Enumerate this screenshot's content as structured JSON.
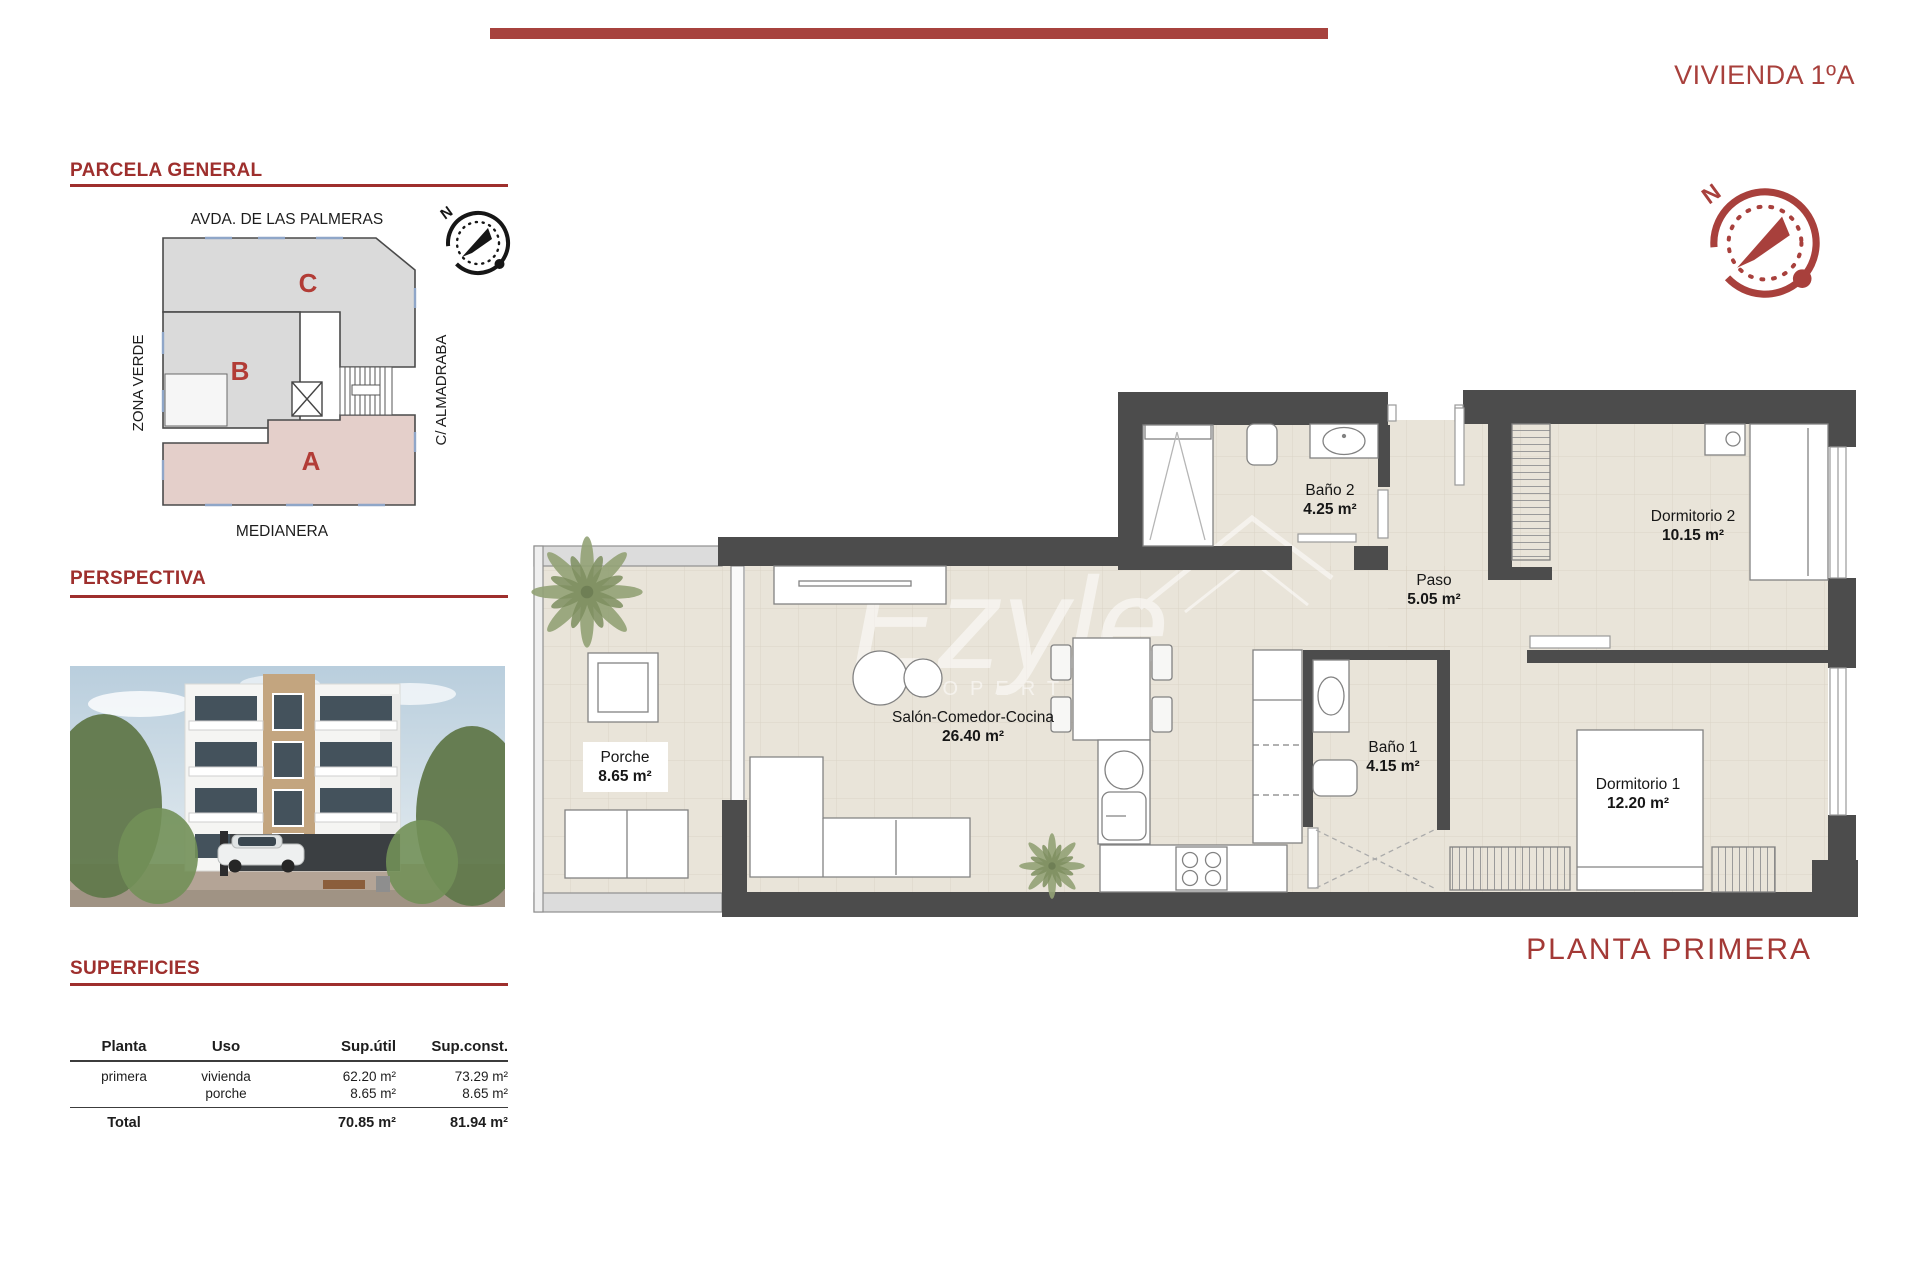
{
  "page": {
    "title_right": "VIVIENDA 1ºA",
    "plan_caption": "PLANTA PRIMERA",
    "north_label": "N"
  },
  "sections": {
    "parcela": "PARCELA GENERAL",
    "perspectiva": "PERSPECTIVA",
    "superficies": "SUPERFICIES"
  },
  "site_plan": {
    "street_top": "AVDA. DE LAS PALMERAS",
    "street_left": "ZONA VERDE",
    "street_right": "C/ ALMADRABA",
    "street_bottom": "MEDIANERA",
    "blocks": [
      "C",
      "B",
      "A"
    ]
  },
  "floor_plan": {
    "rooms": [
      {
        "name": "Porche",
        "area": "8.65 m²"
      },
      {
        "name": "Salón-Comedor-Cocina",
        "area": "26.40 m²"
      },
      {
        "name": "Baño 2",
        "area": "4.25 m²"
      },
      {
        "name": "Paso",
        "area": "5.05 m²"
      },
      {
        "name": "Dormitorio 2",
        "area": "10.15 m²"
      },
      {
        "name": "Baño 1",
        "area": "4.15 m²"
      },
      {
        "name": "Dormitorio 1",
        "area": "12.20 m²"
      }
    ],
    "watermark": {
      "script": "Ezyle",
      "caption": "PROPERTIES"
    }
  },
  "table": {
    "headers": [
      "Planta",
      "Uso",
      "Sup.útil",
      "Sup.const."
    ],
    "rows": [
      {
        "planta": "primera",
        "uso": "vivienda",
        "util": "62.20 m²",
        "const": "73.29 m²"
      },
      {
        "planta": "",
        "uso": "porche",
        "util": "8.65 m²",
        "const": "8.65 m²"
      }
    ],
    "total_label": "Total",
    "total_util": "70.85 m²",
    "total_const": "81.94 m²"
  },
  "colors": {
    "accent_red": "#a23b37",
    "top_bar": "#a7423e",
    "wall_gray": "#4c4c4c",
    "floor_beige": "#e9e4d9",
    "site_block_gray": "#dadada",
    "site_block_pink": "#e4cfca",
    "window_blue": "#8fa6c8"
  }
}
